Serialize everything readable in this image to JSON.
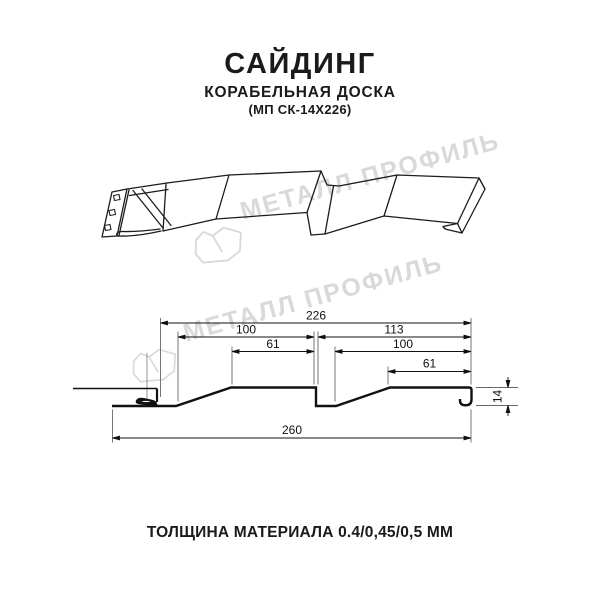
{
  "header": {
    "title": "САЙДИНГ",
    "subtitle": "КОРАБЕЛЬНАЯ ДОСКА",
    "model": "(МП СК-14Х226)"
  },
  "watermark": {
    "brand": "МЕТАЛЛ ПРОФИЛЬ",
    "color": "#d9d9d9"
  },
  "drawing": {
    "type": "siding panel 3d sketch and dimensioned cross-section",
    "line_color": "#1a1a1a"
  },
  "section": {
    "dims": {
      "top_width": "226",
      "board1_width": "100",
      "board1_flat": "61",
      "board2_span": "113",
      "board2_width": "100",
      "board2_flat": "61",
      "total_width": "260",
      "profile_height": "14"
    }
  },
  "footer": {
    "thickness_label": "ТОЛЩИНА МАТЕРИАЛА 0.4/0,45/0,5 ММ"
  }
}
